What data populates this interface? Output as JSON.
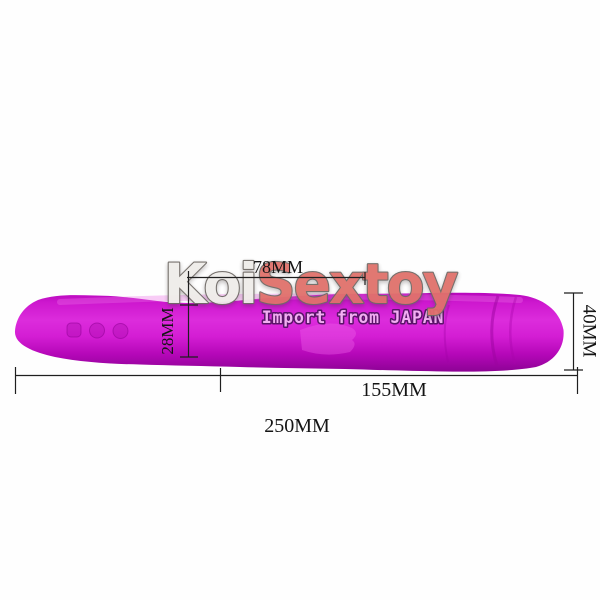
{
  "image": {
    "type": "product-photo",
    "background_color": "#fefefe"
  },
  "watermark": {
    "brand_part1": "Koi",
    "brand_part2": "Sextoy",
    "part1_color": "#efede9",
    "part2_color": "#e0716b",
    "outline_color": "#6f6a66"
  },
  "banner": {
    "text": "Import from JAPAN",
    "text_color": "#f2aef2",
    "outline_color": "#5a1569"
  },
  "product": {
    "kind": "rabbit-vibrator",
    "body_color": "#d41ed4",
    "highlight_color": "#ee5fe8",
    "shadow_color": "#8d0395",
    "button_count": 3
  },
  "dimensions": {
    "line_color": "#1f1f1f",
    "label_color": "#141414",
    "top_section_width": "78MM",
    "shaft_diameter": "28MM",
    "head_diameter": "40MM",
    "insertable_length": "155MM",
    "total_length": "250MM"
  }
}
